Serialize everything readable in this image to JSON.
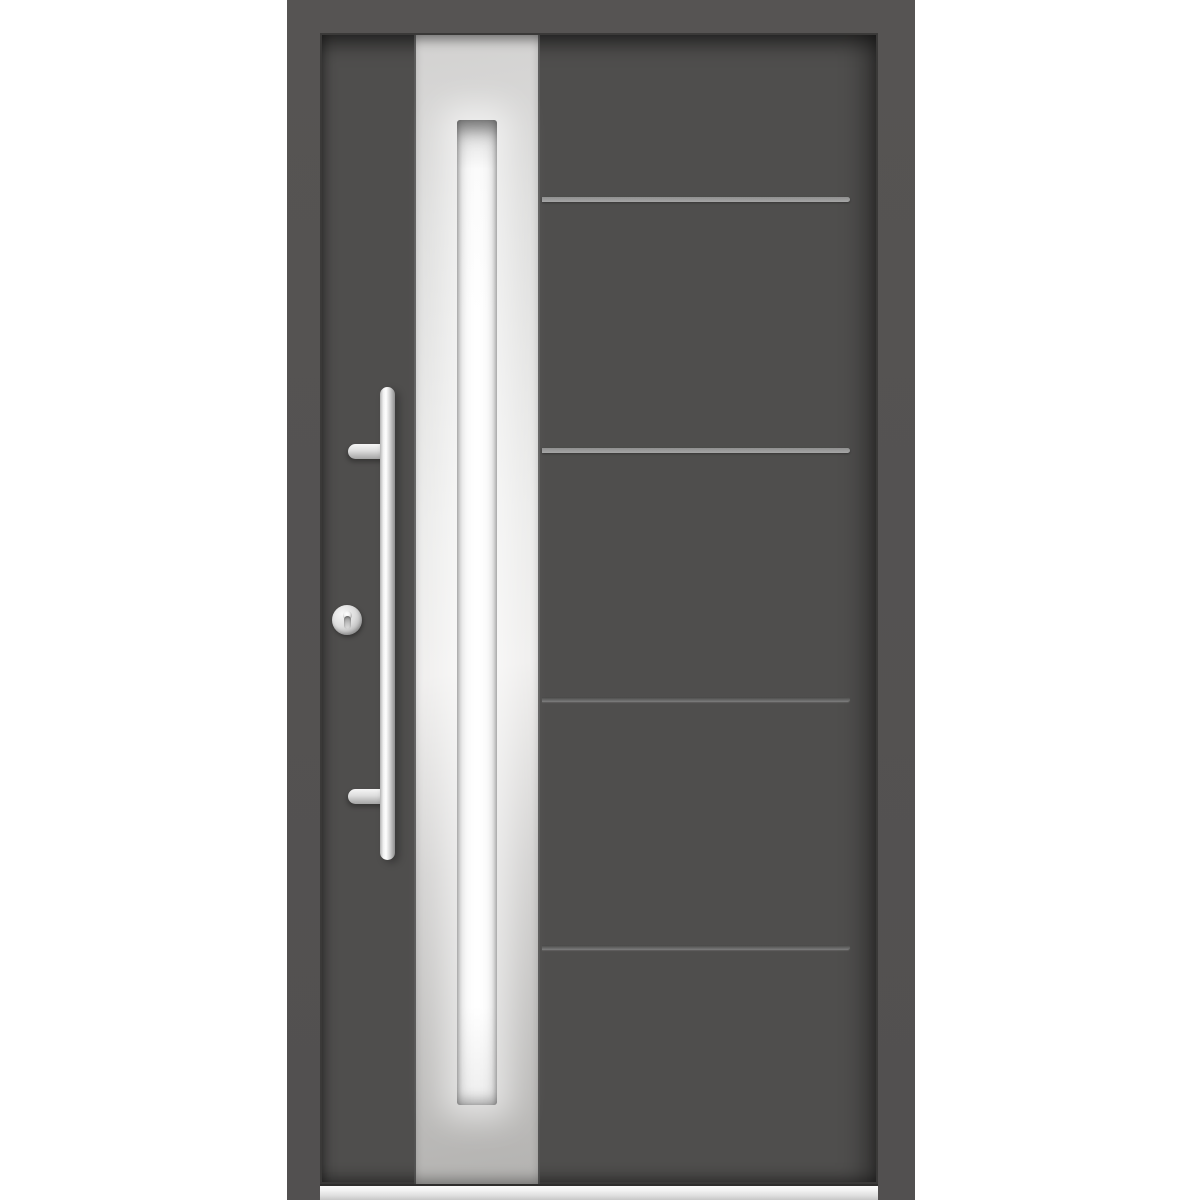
{
  "scene": {
    "type": "product-photo",
    "subject": "Modern anthracite-gray entry door with vertical stainless-steel strip, full-height frosted glass insert, bar pull handle, round lock cylinder and aluminium threshold",
    "background_color": "#ffffff"
  },
  "colors": {
    "background": "#ffffff",
    "frame": "#565453",
    "leaf": "#4f4e4d",
    "leaf-edge": "#3a3938",
    "panel-top": "#d2d1d0",
    "panel-mid": "#ececeb",
    "panel-bottom": "#b3b2b0",
    "glass": "#ffffff",
    "handle-light": "#ffffff",
    "handle-dark": "#8d8d8d",
    "line-bright": "#a6a6a6",
    "line-dark": "#7e7e7e",
    "threshold": "#dedede"
  },
  "trim_lines": [
    {
      "style": "bright",
      "y": 195
    },
    {
      "style": "bright",
      "y": 446
    },
    {
      "style": "dark",
      "y": 695
    },
    {
      "style": "dark",
      "y": 943
    }
  ],
  "hardware": {
    "handle": "vertical stainless bar pull with two mounts",
    "lock": "round cylinder escutcheon with euro keyhole",
    "mount_count": 2
  }
}
